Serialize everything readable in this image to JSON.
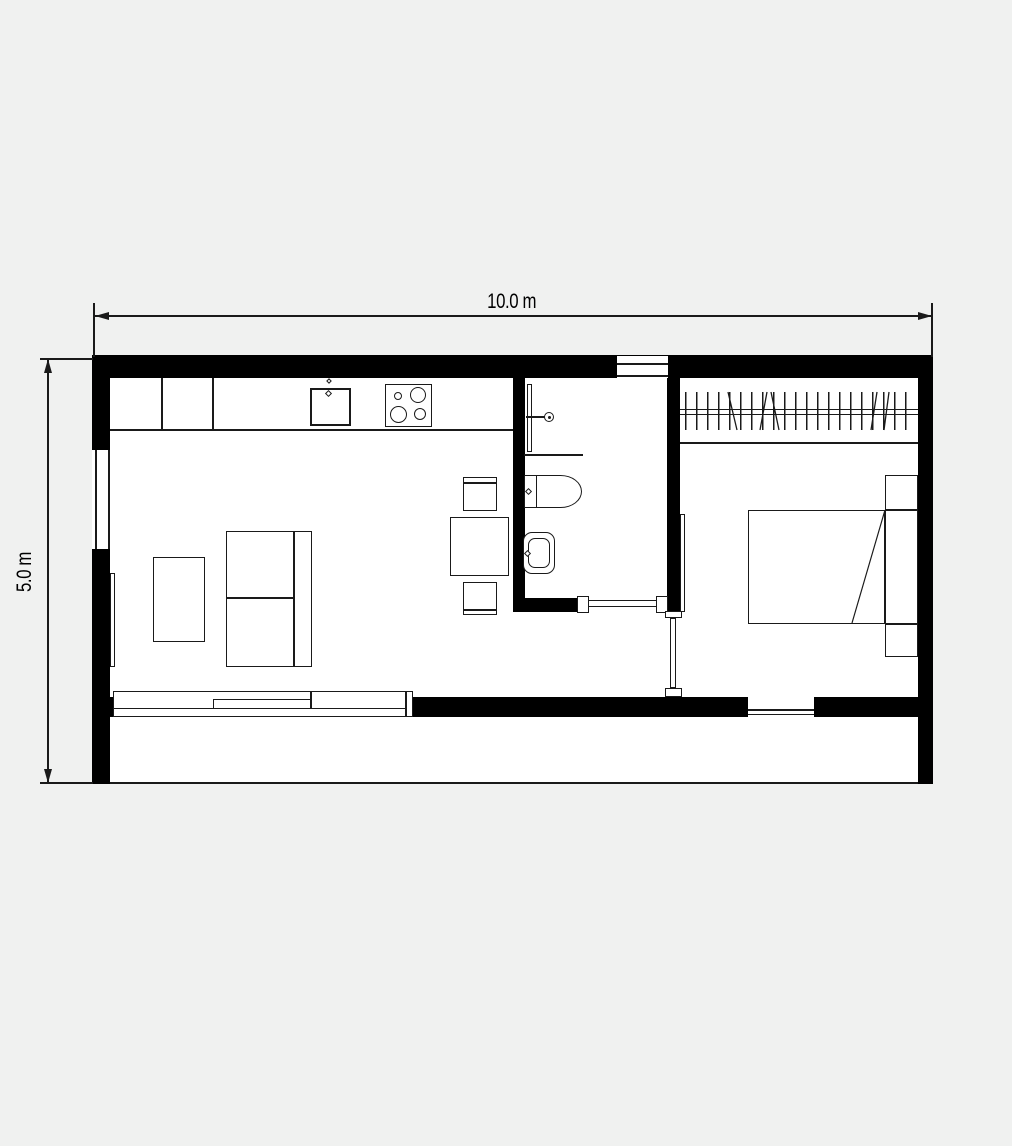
{
  "plan": {
    "type": "floor-plan",
    "dimensions": {
      "width_label": "10.0 m",
      "height_label": "5.0 m"
    },
    "fixtures": [
      "kitchen-counter",
      "kitchen-sink",
      "stove-cooktop",
      "dining-table",
      "dining-chair",
      "dining-chair",
      "sofa",
      "coffee-table",
      "tv-sideboard",
      "shower",
      "toilet",
      "washbasin",
      "wardrobe-rail",
      "double-bed",
      "headboard-nightstands",
      "sliding-glass-door",
      "bathroom-door",
      "bedroom-door",
      "window-top",
      "window-left",
      "window-bottom",
      "terrace"
    ]
  },
  "colors": {
    "bg": "#f0f1f0",
    "wall": "#000000",
    "line": "#1a1a1a",
    "floor": "#ffffff"
  }
}
